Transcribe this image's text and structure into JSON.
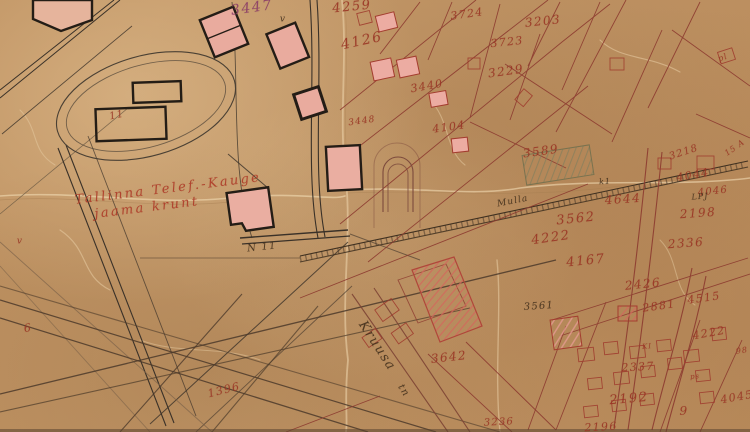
{
  "meta": {
    "kind": "scanned historical cadastral map sheet (aged paper, hand-drawn ink)",
    "site_note": "Tallinna Telef.-Kauge jaama krunt"
  },
  "map": {
    "colors": {
      "paper": "#c49868",
      "ink_black": "#2e2820",
      "ink_red_parcel": "#8d3b30",
      "ink_red_number": "#9b3424",
      "ink_purple_number": "#8c3e69",
      "fill_pink_building": "#ecaca2",
      "hatch_red": "#d4685c",
      "hatch_green": "#7e7e5e"
    },
    "labels": [
      {
        "text": "3447",
        "x": 252,
        "y": 8,
        "size": 14,
        "rot": -8,
        "cls": "purple",
        "name": "parcel-number"
      },
      {
        "text": "4259",
        "x": 352,
        "y": 7,
        "size": 13,
        "rot": -6,
        "cls": "red",
        "name": "parcel-number"
      },
      {
        "text": "3724",
        "x": 467,
        "y": 14,
        "size": 11,
        "rot": -8,
        "cls": "red",
        "name": "parcel-number"
      },
      {
        "text": "3203",
        "x": 543,
        "y": 21,
        "size": 12,
        "rot": -6,
        "cls": "red",
        "name": "parcel-number"
      },
      {
        "text": "4126",
        "x": 362,
        "y": 41,
        "size": 14,
        "rot": -12,
        "cls": "red",
        "name": "parcel-number"
      },
      {
        "text": "3723",
        "x": 507,
        "y": 42,
        "size": 11,
        "rot": -6,
        "cls": "red",
        "name": "parcel-number"
      },
      {
        "text": "3229",
        "x": 506,
        "y": 71,
        "size": 12,
        "rot": -8,
        "cls": "red",
        "name": "parcel-number"
      },
      {
        "text": "3440",
        "x": 427,
        "y": 86,
        "size": 11,
        "rot": -10,
        "cls": "red",
        "name": "parcel-number"
      },
      {
        "text": "3448",
        "x": 362,
        "y": 122,
        "size": 9,
        "rot": -8,
        "cls": "red",
        "name": "parcel-number"
      },
      {
        "text": "4104",
        "x": 449,
        "y": 127,
        "size": 11,
        "rot": -8,
        "cls": "red",
        "name": "parcel-number"
      },
      {
        "text": "3218",
        "x": 684,
        "y": 153,
        "size": 10,
        "rot": -18,
        "cls": "red",
        "name": "parcel-number"
      },
      {
        "text": "3589",
        "x": 541,
        "y": 151,
        "size": 12,
        "rot": -8,
        "cls": "red",
        "name": "parcel-number"
      },
      {
        "text": "4044",
        "x": 693,
        "y": 175,
        "size": 11,
        "rot": -10,
        "cls": "red",
        "name": "parcel-number"
      },
      {
        "text": "4046",
        "x": 713,
        "y": 192,
        "size": 10,
        "rot": -6,
        "cls": "red",
        "name": "parcel-number"
      },
      {
        "text": "4644",
        "x": 623,
        "y": 199,
        "size": 12,
        "rot": -4,
        "cls": "red",
        "name": "parcel-number"
      },
      {
        "text": "2198",
        "x": 698,
        "y": 213,
        "size": 12,
        "rot": -4,
        "cls": "red",
        "name": "parcel-number"
      },
      {
        "text": "3562",
        "x": 576,
        "y": 219,
        "size": 13,
        "rot": -6,
        "cls": "red",
        "name": "parcel-number"
      },
      {
        "text": "4222",
        "x": 551,
        "y": 238,
        "size": 13,
        "rot": -8,
        "cls": "red",
        "name": "parcel-number"
      },
      {
        "text": "2336",
        "x": 686,
        "y": 243,
        "size": 12,
        "rot": -4,
        "cls": "red",
        "name": "parcel-number"
      },
      {
        "text": "4167",
        "x": 586,
        "y": 261,
        "size": 13,
        "rot": -6,
        "cls": "red",
        "name": "parcel-number"
      },
      {
        "text": "2426",
        "x": 643,
        "y": 284,
        "size": 12,
        "rot": -6,
        "cls": "red",
        "name": "parcel-number"
      },
      {
        "text": "2881",
        "x": 659,
        "y": 306,
        "size": 11,
        "rot": -8,
        "cls": "red",
        "name": "parcel-number"
      },
      {
        "text": "4515",
        "x": 704,
        "y": 298,
        "size": 11,
        "rot": -8,
        "cls": "red",
        "name": "parcel-number"
      },
      {
        "text": "3561",
        "x": 539,
        "y": 307,
        "size": 10,
        "rot": -4,
        "cls": "dark",
        "name": "parcel-number"
      },
      {
        "text": "4222",
        "x": 709,
        "y": 333,
        "size": 11,
        "rot": -10,
        "cls": "red",
        "name": "parcel-number"
      },
      {
        "text": "2337",
        "x": 638,
        "y": 367,
        "size": 11,
        "rot": -3,
        "cls": "red",
        "name": "parcel-number"
      },
      {
        "text": "2192",
        "x": 629,
        "y": 399,
        "size": 13,
        "rot": -5,
        "cls": "red",
        "name": "parcel-number"
      },
      {
        "text": "9",
        "x": 684,
        "y": 411,
        "size": 12,
        "rot": 0,
        "cls": "red",
        "name": "parcel-number"
      },
      {
        "text": "4045",
        "x": 737,
        "y": 397,
        "size": 11,
        "rot": -10,
        "cls": "red",
        "name": "parcel-number"
      },
      {
        "text": "2196",
        "x": 601,
        "y": 427,
        "size": 11,
        "rot": -3,
        "cls": "red",
        "name": "parcel-number"
      },
      {
        "text": "3642",
        "x": 449,
        "y": 357,
        "size": 12,
        "rot": -6,
        "cls": "red",
        "name": "parcel-number"
      },
      {
        "text": "3236",
        "x": 499,
        "y": 423,
        "size": 10,
        "rot": -3,
        "cls": "red",
        "name": "parcel-number"
      },
      {
        "text": "1396",
        "x": 224,
        "y": 390,
        "size": 11,
        "rot": -14,
        "cls": "red",
        "name": "parcel-number"
      },
      {
        "text": "6",
        "x": 28,
        "y": 328,
        "size": 11,
        "rot": -10,
        "cls": "red",
        "name": "parcel-number"
      },
      {
        "text": "11",
        "x": 117,
        "y": 116,
        "size": 10,
        "rot": -12,
        "cls": "red",
        "name": "building-number"
      },
      {
        "text": "N 11",
        "x": 262,
        "y": 248,
        "size": 10,
        "rot": -6,
        "cls": "dark",
        "name": "building-number"
      },
      {
        "text": "Tallinna Telef.-Kauge",
        "x": 168,
        "y": 189,
        "size": 13,
        "rot": -7,
        "cls": "script",
        "name": "site-label-line1"
      },
      {
        "text": "jaama krunt",
        "x": 147,
        "y": 208,
        "size": 13,
        "rot": -7,
        "cls": "script",
        "name": "site-label-line2"
      },
      {
        "text": "Kruusa",
        "x": 377,
        "y": 346,
        "size": 13,
        "rot": 57,
        "cls": "dark",
        "name": "street-label-kruusa"
      },
      {
        "text": "tn",
        "x": 403,
        "y": 391,
        "size": 10,
        "rot": 57,
        "cls": "dark",
        "name": "street-label-kruusa-suffix"
      },
      {
        "text": "Mulla",
        "x": 513,
        "y": 202,
        "size": 9,
        "rot": -11,
        "cls": "dark",
        "name": "street-label-mulla"
      },
      {
        "text": "15 A",
        "x": 735,
        "y": 148,
        "size": 8,
        "rot": -35,
        "cls": "red",
        "name": "plot-mark"
      },
      {
        "text": "pl",
        "x": 723,
        "y": 58,
        "size": 8,
        "rot": -20,
        "cls": "red",
        "name": "plot-mark"
      },
      {
        "text": "k1",
        "x": 605,
        "y": 182,
        "size": 8,
        "rot": -4,
        "cls": "dark",
        "name": "plot-mark"
      },
      {
        "text": "LPJ",
        "x": 700,
        "y": 197,
        "size": 8,
        "rot": -4,
        "cls": "dark",
        "name": "plot-mark"
      },
      {
        "text": "KI",
        "x": 647,
        "y": 347,
        "size": 7,
        "rot": -4,
        "cls": "red",
        "name": "plot-mark"
      },
      {
        "text": "ps",
        "x": 695,
        "y": 377,
        "size": 7,
        "rot": -4,
        "cls": "red",
        "name": "plot-mark"
      },
      {
        "text": "98",
        "x": 742,
        "y": 351,
        "size": 8,
        "rot": -8,
        "cls": "red",
        "name": "plot-mark"
      },
      {
        "text": "v",
        "x": 283,
        "y": 20,
        "size": 9,
        "rot": 0,
        "cls": "dark",
        "name": "check-mark"
      },
      {
        "text": "v",
        "x": 20,
        "y": 242,
        "size": 9,
        "rot": 0,
        "cls": "red",
        "name": "check-mark"
      }
    ]
  }
}
